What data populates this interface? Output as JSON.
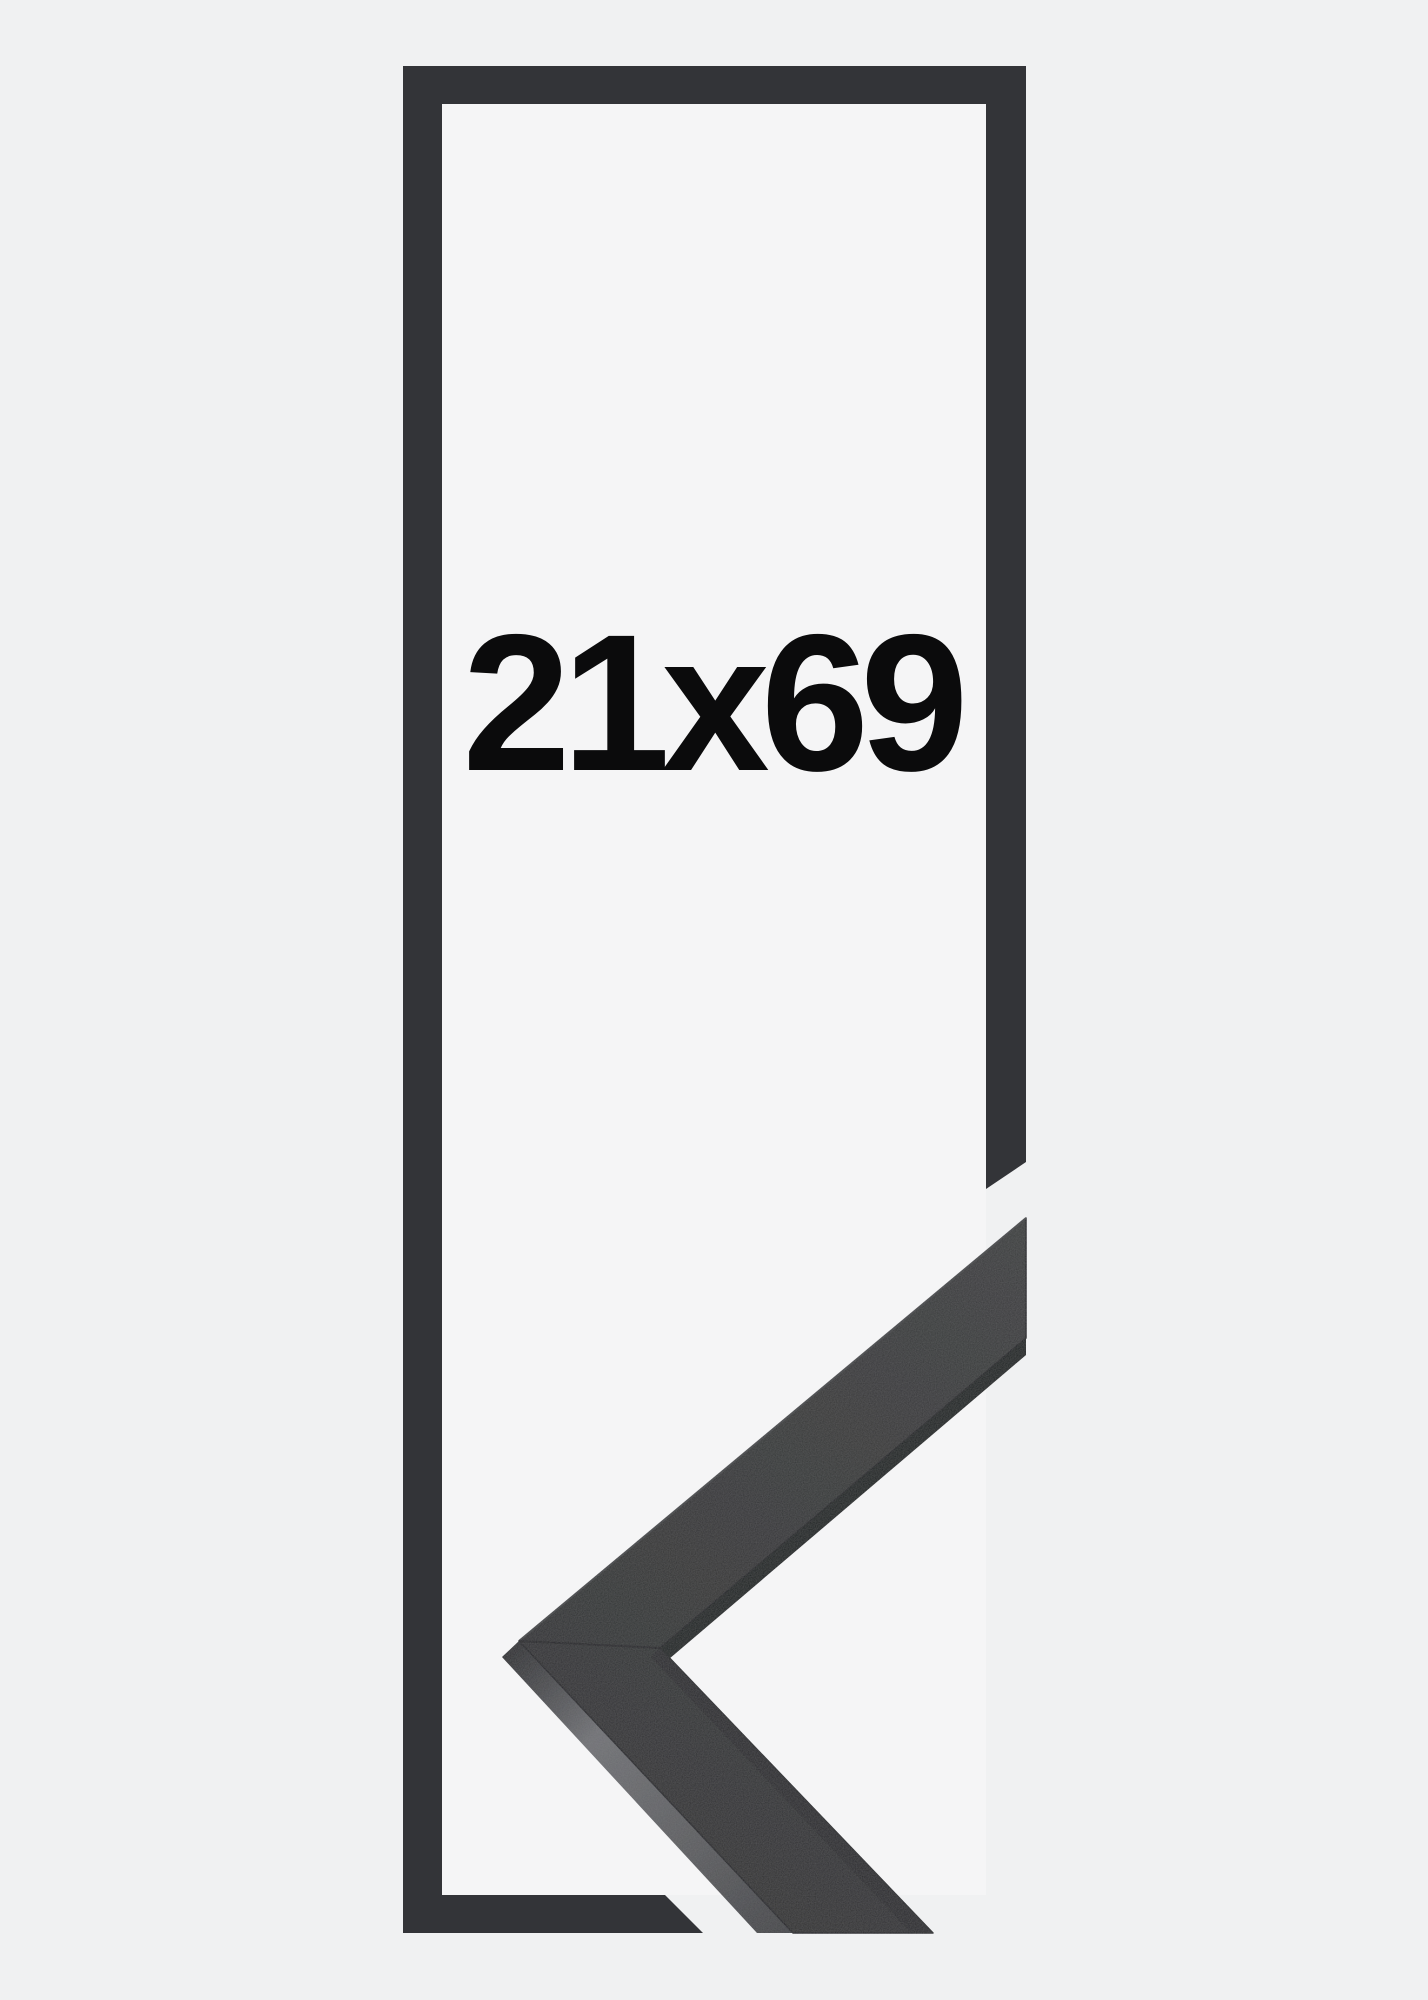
{
  "product_image": {
    "size_label": "21x69"
  },
  "colors": {
    "background": "#f0f1f2",
    "inner_background": "#f5f5f6",
    "outline": "#333438",
    "label_text": "#0b0b0c",
    "moulding_front_dark": "#2f3031",
    "moulding_front_light": "#3b3c3d",
    "moulding_side_shadow": "#1f2023",
    "moulding_side_light": "#707175",
    "moulding_edge": "#232428",
    "seam": "#17181a"
  }
}
